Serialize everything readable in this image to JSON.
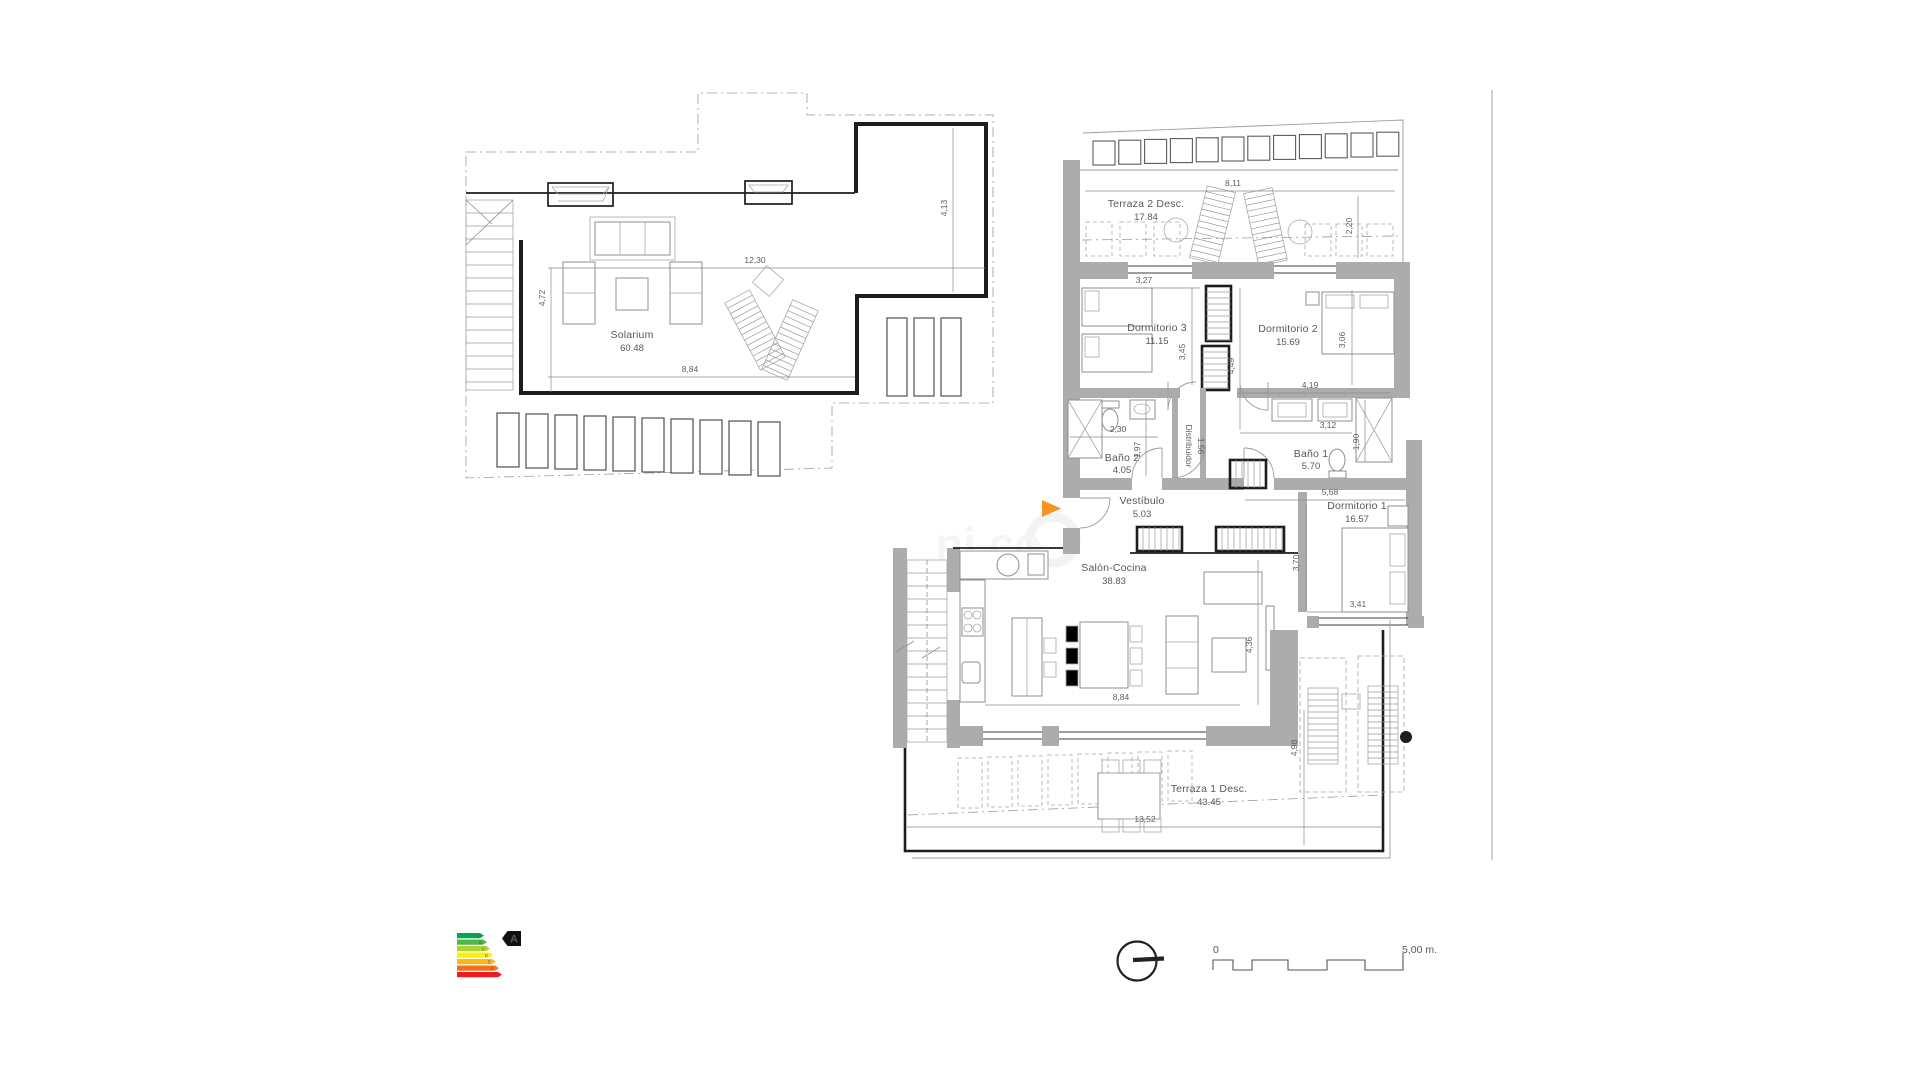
{
  "plan": {
    "rooms": {
      "solarium": {
        "name": "Solarium",
        "area": "60.48"
      },
      "terraza2": {
        "name": "Terraza 2 Desc.",
        "area": "17.84"
      },
      "dormitorio3": {
        "name": "Dormitorio 3",
        "area": "11.15"
      },
      "dormitorio2": {
        "name": "Dormitorio 2",
        "area": "15.69"
      },
      "bano2": {
        "name": "Baño 2",
        "area": "4.05"
      },
      "distribuidor": {
        "name": "Distribuidor",
        "area": "1.56"
      },
      "bano1": {
        "name": "Baño 1",
        "area": "5.70"
      },
      "vestibulo": {
        "name": "Vestíbulo",
        "area": "5.03"
      },
      "dormitorio1": {
        "name": "Dormitorio 1",
        "area": "16.57"
      },
      "salon": {
        "name": "Salón-Cocina",
        "area": "38.83"
      },
      "terraza1": {
        "name": "Terraza 1 Desc.",
        "area": "43.45"
      }
    },
    "dims": {
      "solarium_width": "12,30",
      "solarium_depth": "4,72",
      "solarium_inner_width": "8,84",
      "solarium_side": "4,13",
      "terraza2_width": "8,11",
      "terraza2_depth": "2,20",
      "dorm3_width": "3,27",
      "dorm3_depth": "3,45",
      "pasillo_depth": "4,49",
      "dorm2_depth": "3,06",
      "dorm2_width": "4,19",
      "bano2_width": "2,30",
      "bano2_depth": "1,97",
      "bano1_width": "3,12",
      "bano1_depth": "1,90",
      "dorm1_width": "5,68",
      "dorm1_depth": "3,70",
      "dorm1_bottom_width": "3,41",
      "salon_width": "8,84",
      "salon_depth": "4,36",
      "terraza1_depth": "4,98",
      "terraza1_width": "13,52"
    }
  },
  "energy_label": {
    "rating": "A",
    "bands": [
      {
        "letter": "A",
        "color": "#00A651"
      },
      {
        "letter": "B",
        "color": "#4DB848"
      },
      {
        "letter": "C",
        "color": "#AED136"
      },
      {
        "letter": "D",
        "color": "#FFF200"
      },
      {
        "letter": "E",
        "color": "#FDB913"
      },
      {
        "letter": "F",
        "color": "#F37021"
      },
      {
        "letter": "G",
        "color": "#ED1C24"
      }
    ]
  },
  "scale_bar": {
    "zero": "0",
    "end": "5,00 m."
  },
  "watermark_text": "ni co",
  "colors": {
    "entrance_arrow": "#F7941D",
    "wall_gray": "#ACACAC"
  }
}
